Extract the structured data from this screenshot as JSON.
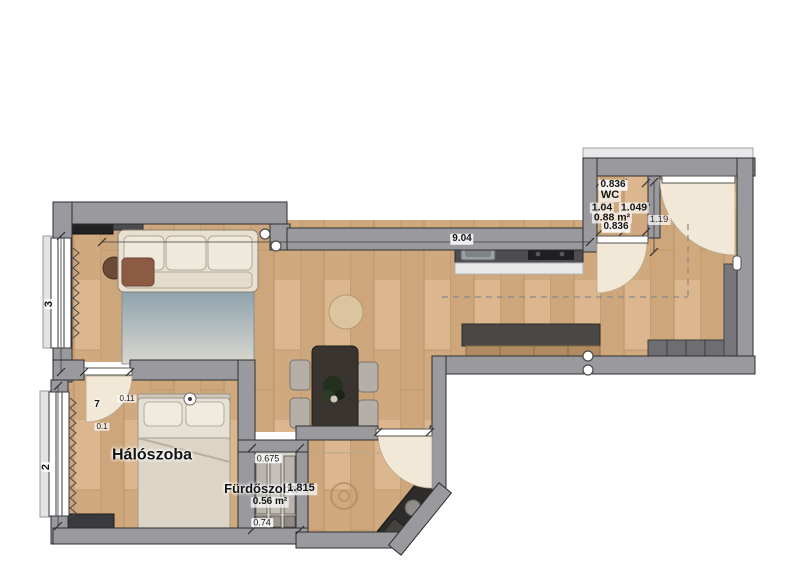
{
  "plan": {
    "rooms": {
      "bedroom": "Hálószoba",
      "bathroom": "Fürdőszoba",
      "wc": "WC"
    },
    "wc_dims": {
      "top": "0.836",
      "left": "1.04",
      "right": "1.049",
      "area": "0.88 m²",
      "bottom": "0.836"
    },
    "dims": {
      "living_width": "9.04",
      "hall_width": "1.19",
      "window_upper": "3",
      "window_lower": "2",
      "bedroom_door": "7",
      "bedroom_door_w": "0.11",
      "bedroom_door_h": "0.1",
      "bathroom_width": "1.815",
      "shaft_width": "0.675",
      "shaft_area": "0.56 m²",
      "shaft_depth": "0.74"
    },
    "colors": {
      "wall": "#9a999e",
      "wall_edge": "#2e2e30",
      "floor_wood": "#d2ab80",
      "door_swing": "#f2e8d7",
      "rug": "#9fb0b8",
      "counter_dark": "#4e4e52"
    }
  }
}
